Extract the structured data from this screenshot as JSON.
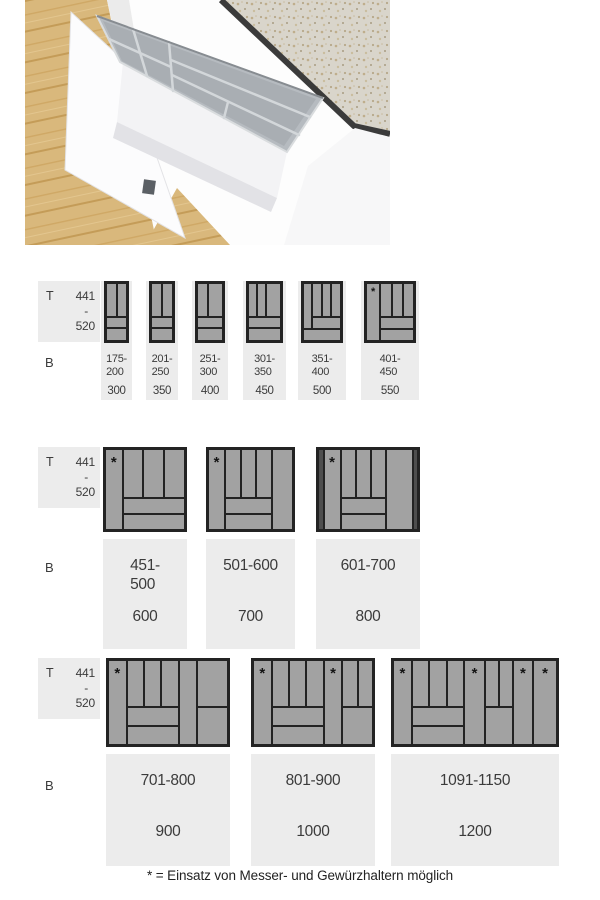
{
  "footnote": "* = Einsatz von Messer- und Gewürzhaltern möglich",
  "star_symbol": "*",
  "depth_label": {
    "prefix": "T",
    "min": "441",
    "dash": "-",
    "max": "520"
  },
  "width_label": "B",
  "colors": {
    "tray_fill": "#a2a2a2",
    "tray_border": "#232323",
    "dark_filler": "#4e4e4e",
    "label_bg": "#ececec",
    "text": "#3b3b3b",
    "star": "#141414"
  },
  "photo": {
    "description": "Pulled-out drawer with grey cutlery insert, wooden floor, stone worktop",
    "colors": {
      "wood": "#d9b87c",
      "wood_streak": "#c49c58",
      "worktop": "#d9d5cb",
      "worktop_speckle": "#b3a383",
      "cabinet_white": "#f7f7f8",
      "drawer_white": "#fcfcfd",
      "insert_grey": "#b6bbc0",
      "insert_slot_grey": "#a9aeb3",
      "logo_grey": "#5b6065",
      "edge_dark": "#3b3b3b"
    }
  },
  "rows": [
    {
      "trays": [
        {
          "range_lines": [
            "175-",
            "200"
          ],
          "nominal": "300",
          "cells": [
            {
              "x": 0,
              "y": 0,
              "w": 0.5,
              "h": 0.58
            },
            {
              "x": 0.5,
              "y": 0,
              "w": 0.5,
              "h": 0.58
            },
            {
              "x": 0,
              "y": 0.58,
              "w": 1,
              "h": 0.2
            },
            {
              "x": 0,
              "y": 0.78,
              "w": 1,
              "h": 0.22
            }
          ]
        },
        {
          "range_lines": [
            "201-",
            "250"
          ],
          "nominal": "350",
          "cells": [
            {
              "x": 0,
              "y": 0,
              "w": 0.5,
              "h": 0.58
            },
            {
              "x": 0.5,
              "y": 0,
              "w": 0.5,
              "h": 0.58
            },
            {
              "x": 0,
              "y": 0.58,
              "w": 1,
              "h": 0.2
            },
            {
              "x": 0,
              "y": 0.78,
              "w": 1,
              "h": 0.22
            }
          ]
        },
        {
          "range_lines": [
            "251-",
            "300"
          ],
          "nominal": "400",
          "cells": [
            {
              "x": 0,
              "y": 0,
              "w": 0.42,
              "h": 0.58
            },
            {
              "x": 0.42,
              "y": 0,
              "w": 0.58,
              "h": 0.58
            },
            {
              "x": 0,
              "y": 0.58,
              "w": 1,
              "h": 0.2
            },
            {
              "x": 0,
              "y": 0.78,
              "w": 1,
              "h": 0.22
            }
          ]
        },
        {
          "range_lines": [
            "301-",
            "350"
          ],
          "nominal": "450",
          "cells": [
            {
              "x": 0,
              "y": 0,
              "w": 0.27,
              "h": 0.58
            },
            {
              "x": 0.27,
              "y": 0,
              "w": 0.27,
              "h": 0.58
            },
            {
              "x": 0.54,
              "y": 0,
              "w": 0.46,
              "h": 0.58
            },
            {
              "x": 0,
              "y": 0.58,
              "w": 1,
              "h": 0.2
            },
            {
              "x": 0,
              "y": 0.78,
              "w": 1,
              "h": 0.22
            }
          ]
        },
        {
          "range_lines": [
            "351-",
            "400"
          ],
          "nominal": "500",
          "cells": [
            {
              "x": 0,
              "y": 0,
              "w": 0.24,
              "h": 0.8
            },
            {
              "x": 0.24,
              "y": 0,
              "w": 0.253,
              "h": 0.58
            },
            {
              "x": 0.493,
              "y": 0,
              "w": 0.253,
              "h": 0.58
            },
            {
              "x": 0.747,
              "y": 0,
              "w": 0.253,
              "h": 0.58
            },
            {
              "x": 0.24,
              "y": 0.58,
              "w": 0.76,
              "h": 0.22
            },
            {
              "x": 0,
              "y": 0.8,
              "w": 1,
              "h": 0.2
            }
          ]
        },
        {
          "range_lines": [
            "401-",
            "450"
          ],
          "nominal": "550",
          "cells": [
            {
              "x": 0,
              "y": 0,
              "w": 0.3,
              "h": 1,
              "star": true
            },
            {
              "x": 0.3,
              "y": 0,
              "w": 0.233,
              "h": 0.58
            },
            {
              "x": 0.533,
              "y": 0,
              "w": 0.234,
              "h": 0.58
            },
            {
              "x": 0.767,
              "y": 0,
              "w": 0.233,
              "h": 0.58
            },
            {
              "x": 0.3,
              "y": 0.58,
              "w": 0.7,
              "h": 0.21
            },
            {
              "x": 0.3,
              "y": 0.79,
              "w": 0.7,
              "h": 0.21
            }
          ]
        }
      ]
    },
    {
      "trays": [
        {
          "range_lines": [
            "451-",
            "500"
          ],
          "nominal": "600",
          "cells": [
            {
              "x": 0,
              "y": 0,
              "w": 0.22,
              "h": 1,
              "star": true
            },
            {
              "x": 0.22,
              "y": 0,
              "w": 0.26,
              "h": 0.6
            },
            {
              "x": 0.48,
              "y": 0,
              "w": 0.26,
              "h": 0.6
            },
            {
              "x": 0.74,
              "y": 0,
              "w": 0.26,
              "h": 0.6
            },
            {
              "x": 0.22,
              "y": 0.6,
              "w": 0.78,
              "h": 0.2
            },
            {
              "x": 0.22,
              "y": 0.8,
              "w": 0.78,
              "h": 0.2
            }
          ]
        },
        {
          "range_lines": [
            "501-600"
          ],
          "nominal": "700",
          "cells": [
            {
              "x": 0,
              "y": 0,
              "w": 0.2,
              "h": 1,
              "star": true
            },
            {
              "x": 0.2,
              "y": 0,
              "w": 0.185,
              "h": 0.6
            },
            {
              "x": 0.385,
              "y": 0,
              "w": 0.185,
              "h": 0.6
            },
            {
              "x": 0.57,
              "y": 0,
              "w": 0.185,
              "h": 0.6
            },
            {
              "x": 0.755,
              "y": 0,
              "w": 0.245,
              "h": 1
            },
            {
              "x": 0.2,
              "y": 0.6,
              "w": 0.555,
              "h": 0.2
            },
            {
              "x": 0.2,
              "y": 0.8,
              "w": 0.555,
              "h": 0.2
            }
          ]
        },
        {
          "range_lines": [
            "601-700"
          ],
          "nominal": "800",
          "cells": [
            {
              "x": 0,
              "y": 0,
              "w": 0.055,
              "h": 1,
              "dark": true
            },
            {
              "x": 0.055,
              "y": 0,
              "w": 0.17,
              "h": 1,
              "star": true
            },
            {
              "x": 0.225,
              "y": 0,
              "w": 0.15,
              "h": 0.6
            },
            {
              "x": 0.375,
              "y": 0,
              "w": 0.15,
              "h": 0.6
            },
            {
              "x": 0.525,
              "y": 0,
              "w": 0.15,
              "h": 0.6
            },
            {
              "x": 0.675,
              "y": 0,
              "w": 0.27,
              "h": 1
            },
            {
              "x": 0.945,
              "y": 0,
              "w": 0.055,
              "h": 1,
              "dark": true
            },
            {
              "x": 0.225,
              "y": 0.6,
              "w": 0.45,
              "h": 0.2
            },
            {
              "x": 0.225,
              "y": 0.8,
              "w": 0.45,
              "h": 0.2
            }
          ]
        }
      ]
    },
    {
      "trays": [
        {
          "range_lines": [
            "701-800"
          ],
          "nominal": "900",
          "cells": [
            {
              "x": 0,
              "y": 0,
              "w": 0.155,
              "h": 1,
              "star": true
            },
            {
              "x": 0.155,
              "y": 0,
              "w": 0.145,
              "h": 0.55
            },
            {
              "x": 0.3,
              "y": 0,
              "w": 0.145,
              "h": 0.55
            },
            {
              "x": 0.445,
              "y": 0,
              "w": 0.145,
              "h": 0.55
            },
            {
              "x": 0.155,
              "y": 0.55,
              "w": 0.435,
              "h": 0.225
            },
            {
              "x": 0.155,
              "y": 0.775,
              "w": 0.435,
              "h": 0.225
            },
            {
              "x": 0.59,
              "y": 0,
              "w": 0.155,
              "h": 1
            },
            {
              "x": 0.745,
              "y": 0,
              "w": 0.255,
              "h": 0.55
            },
            {
              "x": 0.745,
              "y": 0.55,
              "w": 0.255,
              "h": 0.45
            }
          ]
        },
        {
          "range_lines": [
            "801-900"
          ],
          "nominal": "1000",
          "cells": [
            {
              "x": 0,
              "y": 0,
              "w": 0.155,
              "h": 1,
              "star": true
            },
            {
              "x": 0.155,
              "y": 0,
              "w": 0.145,
              "h": 0.55
            },
            {
              "x": 0.3,
              "y": 0,
              "w": 0.145,
              "h": 0.55
            },
            {
              "x": 0.445,
              "y": 0,
              "w": 0.145,
              "h": 0.55
            },
            {
              "x": 0.155,
              "y": 0.55,
              "w": 0.435,
              "h": 0.225
            },
            {
              "x": 0.155,
              "y": 0.775,
              "w": 0.435,
              "h": 0.225
            },
            {
              "x": 0.59,
              "y": 0,
              "w": 0.155,
              "h": 1,
              "star": true
            },
            {
              "x": 0.745,
              "y": 0,
              "w": 0.1275,
              "h": 0.55
            },
            {
              "x": 0.8725,
              "y": 0,
              "w": 0.1275,
              "h": 0.55
            },
            {
              "x": 0.745,
              "y": 0.55,
              "w": 0.255,
              "h": 0.45
            }
          ]
        },
        {
          "range_lines": [
            "1091-1150"
          ],
          "nominal": "1200",
          "cells": [
            {
              "x": 0,
              "y": 0,
              "w": 0.115,
              "h": 1,
              "star": true
            },
            {
              "x": 0.115,
              "y": 0,
              "w": 0.107,
              "h": 0.55
            },
            {
              "x": 0.222,
              "y": 0,
              "w": 0.107,
              "h": 0.55
            },
            {
              "x": 0.329,
              "y": 0,
              "w": 0.106,
              "h": 0.55
            },
            {
              "x": 0.115,
              "y": 0.55,
              "w": 0.32,
              "h": 0.225
            },
            {
              "x": 0.115,
              "y": 0.775,
              "w": 0.32,
              "h": 0.225
            },
            {
              "x": 0.435,
              "y": 0,
              "w": 0.125,
              "h": 1,
              "star": true
            },
            {
              "x": 0.56,
              "y": 0,
              "w": 0.085,
              "h": 0.55
            },
            {
              "x": 0.645,
              "y": 0,
              "w": 0.085,
              "h": 0.55
            },
            {
              "x": 0.56,
              "y": 0.55,
              "w": 0.17,
              "h": 0.45
            },
            {
              "x": 0.73,
              "y": 0,
              "w": 0.125,
              "h": 1,
              "star": true
            },
            {
              "x": 0.855,
              "y": 0,
              "w": 0.145,
              "h": 1,
              "star": true
            }
          ]
        }
      ]
    }
  ]
}
